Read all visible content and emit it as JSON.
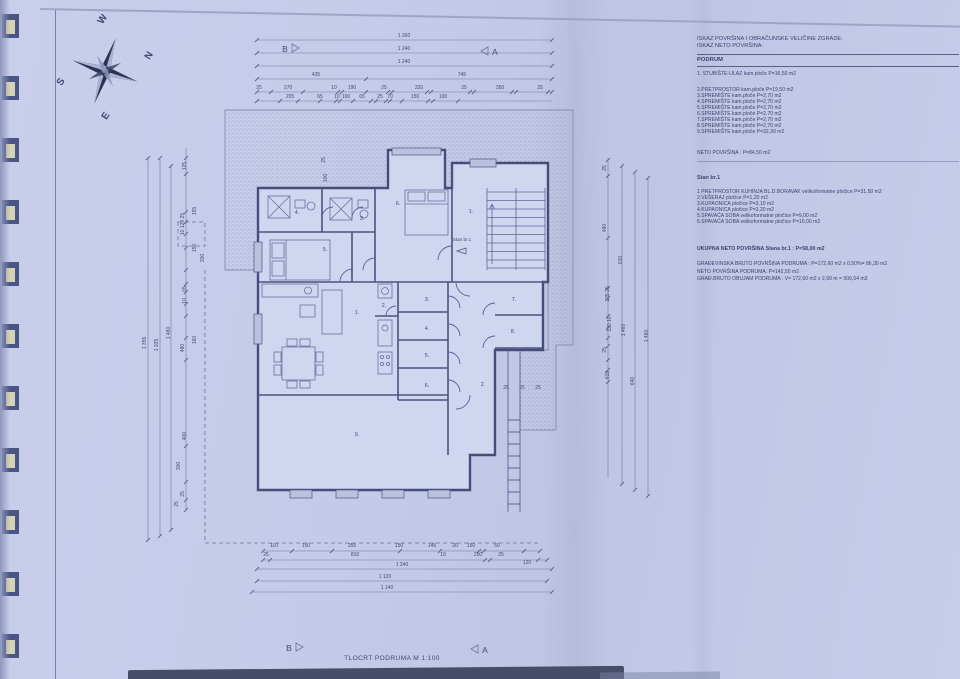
{
  "sheet": {
    "title": "TLOCRT PODRUMA M 1:100",
    "marker_a": "A",
    "marker_b": "B",
    "stan_annotation": "Stan br.1",
    "colors": {
      "paper": "#c5cbe8",
      "ink": "#39426e",
      "wall": "#454e78",
      "hatch_dot": "#8a93b6"
    }
  },
  "compass": {
    "n": "N",
    "s": "S",
    "e": "E",
    "w": "W"
  },
  "table": {
    "title_lines": [
      "ISKAZ POVRŠINA I OBRAČUNSKE VELIČINE ZGRADE:",
      "ISKAZ NETO POVRŠINA:"
    ],
    "section1_header": "PODRUM",
    "podrum_items": [
      "1. STUBIŠTE-ULAZ  kam.ploče P=16,50 m2",
      "2.PRETPROSTOR kam.ploče P=19,50 m2",
      "3.SPREMIŠTE kam.ploče P=2,70 m2",
      "4.SPREMIŠTE kam.ploče P=2,70 m2",
      "5.SPREMIŠTE kam.ploče P=2,70 m2",
      "6.SPREMIŠTE kam.ploče P=2,70 m2",
      "7.SPREMIŠTE kam.ploče P=2,70 m2",
      "8.SPREMIŠTE kam.ploče P=2,70 m2",
      "9.SPREMIŠTE kam.ploče P=32,30 m2"
    ],
    "podrum_total": "NETO POVRŠINA  :  P=84,50 m2",
    "section2_header": "Stan br.1",
    "stan_items": [
      "1 PRETPROSTOR KUHINJA BL.D.BORAVAK velikoformatne pločice P=31,50 m2",
      "2.VEŠERAJ pločice P=1,20 m2",
      "3.KUPAONICA pločice   P=3,10 m2",
      "4.KUPAONICA pločice  P=3,20 m2",
      "5.SPAVAĆA SOBA velikoformatne pločice P=9,00 m2",
      "6.SPAVAĆA SOBA  velikoformatne pločice P=10,00 m2"
    ],
    "stan_total": "UKUPNA NETO POVRŠINA Stana br.1 : P=58,00 m2",
    "summary_lines": [
      "GRAĐEVINSKA BRUTO POVRŠINA PODRUMA : P=172,60 m2 x 0,50%= 86,30 m2",
      "NETO POVRŠINA PODRUMA: P=142,50 m2",
      "GRAĐ.BRUTO OBUJAM PODRUMA : V= 172,60 m2 x 2,90 m = 500,54 m3"
    ]
  },
  "plan": {
    "room_labels": [
      {
        "t": "4.",
        "x": 157,
        "y": 206
      },
      {
        "t": "3.",
        "x": 222,
        "y": 212
      },
      {
        "t": "5.",
        "x": 185,
        "y": 243
      },
      {
        "t": "6.",
        "x": 258,
        "y": 197
      },
      {
        "t": "1.",
        "x": 331,
        "y": 205
      },
      {
        "t": "2.",
        "x": 244,
        "y": 299
      },
      {
        "t": "1.",
        "x": 217,
        "y": 306
      },
      {
        "t": "3.",
        "x": 287,
        "y": 293
      },
      {
        "t": "4.",
        "x": 287,
        "y": 322
      },
      {
        "t": "5.",
        "x": 287,
        "y": 349
      },
      {
        "t": "6.",
        "x": 287,
        "y": 379
      },
      {
        "t": "7.",
        "x": 374,
        "y": 293
      },
      {
        "t": "8.",
        "x": 373,
        "y": 325
      },
      {
        "t": "2.",
        "x": 343,
        "y": 378
      },
      {
        "t": "9.",
        "x": 217,
        "y": 428
      }
    ],
    "dim_texts": [
      {
        "t": "1 260",
        "x": 264,
        "y": 29
      },
      {
        "t": "1 240",
        "x": 264,
        "y": 42
      },
      {
        "t": "1 240",
        "x": 264,
        "y": 55
      },
      {
        "t": "435",
        "x": 176,
        "y": 68
      },
      {
        "t": "745",
        "x": 322,
        "y": 68
      },
      {
        "t": "25",
        "x": 119,
        "y": 81
      },
      {
        "t": "270",
        "x": 148,
        "y": 81
      },
      {
        "t": "10",
        "x": 194,
        "y": 81
      },
      {
        "t": "190",
        "x": 212,
        "y": 81
      },
      {
        "t": "25",
        "x": 244,
        "y": 81
      },
      {
        "t": "320",
        "x": 279,
        "y": 81
      },
      {
        "t": "25",
        "x": 324,
        "y": 81
      },
      {
        "t": "350",
        "x": 360,
        "y": 81
      },
      {
        "t": "25",
        "x": 400,
        "y": 81
      },
      {
        "t": "205",
        "x": 150,
        "y": 90
      },
      {
        "t": "65",
        "x": 180,
        "y": 90
      },
      {
        "t": "10",
        "x": 197,
        "y": 90
      },
      {
        "t": "100",
        "x": 206,
        "y": 90
      },
      {
        "t": "65",
        "x": 222,
        "y": 90
      },
      {
        "t": "25",
        "x": 240,
        "y": 90
      },
      {
        "t": "70",
        "x": 250,
        "y": 90
      },
      {
        "t": "150",
        "x": 275,
        "y": 90
      },
      {
        "t": "100",
        "x": 303,
        "y": 90
      },
      {
        "t": "110",
        "x": 134,
        "y": 539
      },
      {
        "t": "150",
        "x": 166,
        "y": 539
      },
      {
        "t": "255",
        "x": 212,
        "y": 539
      },
      {
        "t": "150",
        "x": 259,
        "y": 539
      },
      {
        "t": "145",
        "x": 292,
        "y": 539
      },
      {
        "t": "20",
        "x": 315,
        "y": 539
      },
      {
        "t": "150",
        "x": 331,
        "y": 539
      },
      {
        "t": "60",
        "x": 357,
        "y": 539
      },
      {
        "t": "25",
        "x": 126,
        "y": 548
      },
      {
        "t": "810",
        "x": 215,
        "y": 548
      },
      {
        "t": "10",
        "x": 303,
        "y": 548
      },
      {
        "t": "250",
        "x": 338,
        "y": 548
      },
      {
        "t": "25",
        "x": 361,
        "y": 548
      },
      {
        "t": "120",
        "x": 387,
        "y": 556
      },
      {
        "t": "1 240",
        "x": 262,
        "y": 558
      },
      {
        "t": "1 120",
        "x": 245,
        "y": 570
      },
      {
        "t": "1 140",
        "x": 247,
        "y": 581
      },
      {
        "t": "1 355",
        "x": 6,
        "y": 335,
        "r": 1
      },
      {
        "t": "1 335",
        "x": 18,
        "y": 337,
        "r": 1
      },
      {
        "t": "1 480",
        "x": 30,
        "y": 325,
        "r": 1
      },
      {
        "t": "125",
        "x": 46,
        "y": 158,
        "r": 1
      },
      {
        "t": "155",
        "x": 56,
        "y": 203,
        "r": 1
      },
      {
        "t": "10 120 25",
        "x": 44,
        "y": 216,
        "r": 1
      },
      {
        "t": "150",
        "x": 56,
        "y": 240,
        "r": 1
      },
      {
        "t": "200",
        "x": 64,
        "y": 250,
        "r": 1
      },
      {
        "t": "65",
        "x": 46,
        "y": 281,
        "r": 1
      },
      {
        "t": "10",
        "x": 46,
        "y": 293,
        "r": 1
      },
      {
        "t": "160",
        "x": 56,
        "y": 332,
        "r": 1
      },
      {
        "t": "480",
        "x": 44,
        "y": 340,
        "r": 1
      },
      {
        "t": "400",
        "x": 46,
        "y": 428,
        "r": 1
      },
      {
        "t": "300",
        "x": 40,
        "y": 458,
        "r": 1
      },
      {
        "t": "25",
        "x": 44,
        "y": 486,
        "r": 1
      },
      {
        "t": "25",
        "x": 38,
        "y": 496,
        "r": 1
      },
      {
        "t": "25",
        "x": 466,
        "y": 160,
        "r": 1
      },
      {
        "t": "480",
        "x": 466,
        "y": 220,
        "r": 1
      },
      {
        "t": "125 25",
        "x": 469,
        "y": 286,
        "r": 1
      },
      {
        "t": "130 10",
        "x": 471,
        "y": 316,
        "r": 1
      },
      {
        "t": "25",
        "x": 466,
        "y": 342,
        "r": 1
      },
      {
        "t": "615",
        "x": 469,
        "y": 367,
        "r": 1
      },
      {
        "t": "620",
        "x": 482,
        "y": 252,
        "r": 1
      },
      {
        "t": "640",
        "x": 494,
        "y": 373,
        "r": 1
      },
      {
        "t": "1 460",
        "x": 485,
        "y": 322,
        "r": 1
      },
      {
        "t": "1 480",
        "x": 508,
        "y": 328,
        "r": 1
      },
      {
        "t": "25",
        "x": 185,
        "y": 152,
        "r": 1
      },
      {
        "t": "100",
        "x": 187,
        "y": 170,
        "r": 1
      },
      {
        "t": "25",
        "x": 366,
        "y": 381
      },
      {
        "t": "25",
        "x": 382,
        "y": 381
      },
      {
        "t": "25",
        "x": 398,
        "y": 381
      }
    ],
    "dim_lines": [
      [
        117,
        32,
        412,
        32
      ],
      [
        117,
        45,
        412,
        45
      ],
      [
        117,
        58,
        412,
        58
      ],
      [
        117,
        71,
        412,
        71
      ],
      [
        117,
        84,
        412,
        84
      ],
      [
        117,
        93,
        412,
        93
      ],
      [
        123,
        543,
        400,
        543
      ],
      [
        123,
        552,
        407,
        552
      ],
      [
        117,
        561,
        412,
        561
      ],
      [
        117,
        573,
        407,
        573
      ],
      [
        112,
        584,
        412,
        584
      ],
      [
        8,
        150,
        8,
        532
      ],
      [
        20,
        150,
        20,
        528
      ],
      [
        31,
        158,
        31,
        522
      ],
      [
        46,
        140,
        46,
        502
      ],
      [
        468,
        150,
        468,
        470
      ],
      [
        482,
        158,
        482,
        476
      ],
      [
        495,
        164,
        495,
        482
      ],
      [
        508,
        170,
        508,
        488
      ]
    ],
    "ticks": [
      {
        "x": 117,
        "y": 32
      },
      {
        "x": 412,
        "y": 32
      },
      {
        "x": 117,
        "y": 45
      },
      {
        "x": 412,
        "y": 45
      },
      {
        "x": 117,
        "y": 58
      },
      {
        "x": 412,
        "y": 58
      },
      {
        "x": 117,
        "y": 71
      },
      {
        "x": 226,
        "y": 71
      },
      {
        "x": 412,
        "y": 71
      },
      {
        "x": 117,
        "y": 84
      },
      {
        "x": 131,
        "y": 84
      },
      {
        "x": 163,
        "y": 84
      },
      {
        "x": 198,
        "y": 84
      },
      {
        "x": 202,
        "y": 84
      },
      {
        "x": 226,
        "y": 84
      },
      {
        "x": 248,
        "y": 84
      },
      {
        "x": 252,
        "y": 84
      },
      {
        "x": 287,
        "y": 84
      },
      {
        "x": 291,
        "y": 84
      },
      {
        "x": 330,
        "y": 84
      },
      {
        "x": 334,
        "y": 84
      },
      {
        "x": 372,
        "y": 84
      },
      {
        "x": 376,
        "y": 84
      },
      {
        "x": 408,
        "y": 84
      },
      {
        "x": 412,
        "y": 84
      },
      {
        "x": 117,
        "y": 93
      },
      {
        "x": 140,
        "y": 93
      },
      {
        "x": 158,
        "y": 93
      },
      {
        "x": 180,
        "y": 93
      },
      {
        "x": 196,
        "y": 93
      },
      {
        "x": 200,
        "y": 93
      },
      {
        "x": 213,
        "y": 93
      },
      {
        "x": 231,
        "y": 93
      },
      {
        "x": 236,
        "y": 93
      },
      {
        "x": 246,
        "y": 93
      },
      {
        "x": 250,
        "y": 93
      },
      {
        "x": 262,
        "y": 93
      },
      {
        "x": 288,
        "y": 93
      },
      {
        "x": 293,
        "y": 93
      },
      {
        "x": 318,
        "y": 93
      },
      {
        "x": 123,
        "y": 543
      },
      {
        "x": 152,
        "y": 543
      },
      {
        "x": 192,
        "y": 543
      },
      {
        "x": 260,
        "y": 543
      },
      {
        "x": 300,
        "y": 543
      },
      {
        "x": 339,
        "y": 543
      },
      {
        "x": 344,
        "y": 543
      },
      {
        "x": 384,
        "y": 543
      },
      {
        "x": 400,
        "y": 543
      },
      {
        "x": 123,
        "y": 552
      },
      {
        "x": 130,
        "y": 552
      },
      {
        "x": 345,
        "y": 552
      },
      {
        "x": 350,
        "y": 552
      },
      {
        "x": 398,
        "y": 552
      },
      {
        "x": 407,
        "y": 552
      },
      {
        "x": 117,
        "y": 561
      },
      {
        "x": 412,
        "y": 561
      },
      {
        "x": 117,
        "y": 573
      },
      {
        "x": 407,
        "y": 573
      },
      {
        "x": 112,
        "y": 584
      },
      {
        "x": 412,
        "y": 584
      },
      {
        "x": 8,
        "y": 150
      },
      {
        "x": 8,
        "y": 532
      },
      {
        "x": 20,
        "y": 150
      },
      {
        "x": 20,
        "y": 528
      },
      {
        "x": 31,
        "y": 158
      },
      {
        "x": 31,
        "y": 522
      },
      {
        "x": 46,
        "y": 150
      },
      {
        "x": 46,
        "y": 166
      },
      {
        "x": 46,
        "y": 204
      },
      {
        "x": 46,
        "y": 214
      },
      {
        "x": 46,
        "y": 226
      },
      {
        "x": 46,
        "y": 240
      },
      {
        "x": 46,
        "y": 262
      },
      {
        "x": 46,
        "y": 276
      },
      {
        "x": 46,
        "y": 284
      },
      {
        "x": 46,
        "y": 296
      },
      {
        "x": 46,
        "y": 308
      },
      {
        "x": 46,
        "y": 330
      },
      {
        "x": 46,
        "y": 352
      },
      {
        "x": 46,
        "y": 438
      },
      {
        "x": 46,
        "y": 474
      },
      {
        "x": 46,
        "y": 492
      },
      {
        "x": 46,
        "y": 502
      },
      {
        "x": 468,
        "y": 152
      },
      {
        "x": 468,
        "y": 168
      },
      {
        "x": 468,
        "y": 230
      },
      {
        "x": 468,
        "y": 280
      },
      {
        "x": 468,
        "y": 290
      },
      {
        "x": 468,
        "y": 308
      },
      {
        "x": 468,
        "y": 320
      },
      {
        "x": 468,
        "y": 330
      },
      {
        "x": 468,
        "y": 338
      },
      {
        "x": 468,
        "y": 352
      },
      {
        "x": 468,
        "y": 362
      },
      {
        "x": 468,
        "y": 374
      },
      {
        "x": 482,
        "y": 158
      },
      {
        "x": 482,
        "y": 476
      },
      {
        "x": 495,
        "y": 164
      },
      {
        "x": 495,
        "y": 482
      },
      {
        "x": 508,
        "y": 170
      },
      {
        "x": 508,
        "y": 488
      }
    ]
  }
}
